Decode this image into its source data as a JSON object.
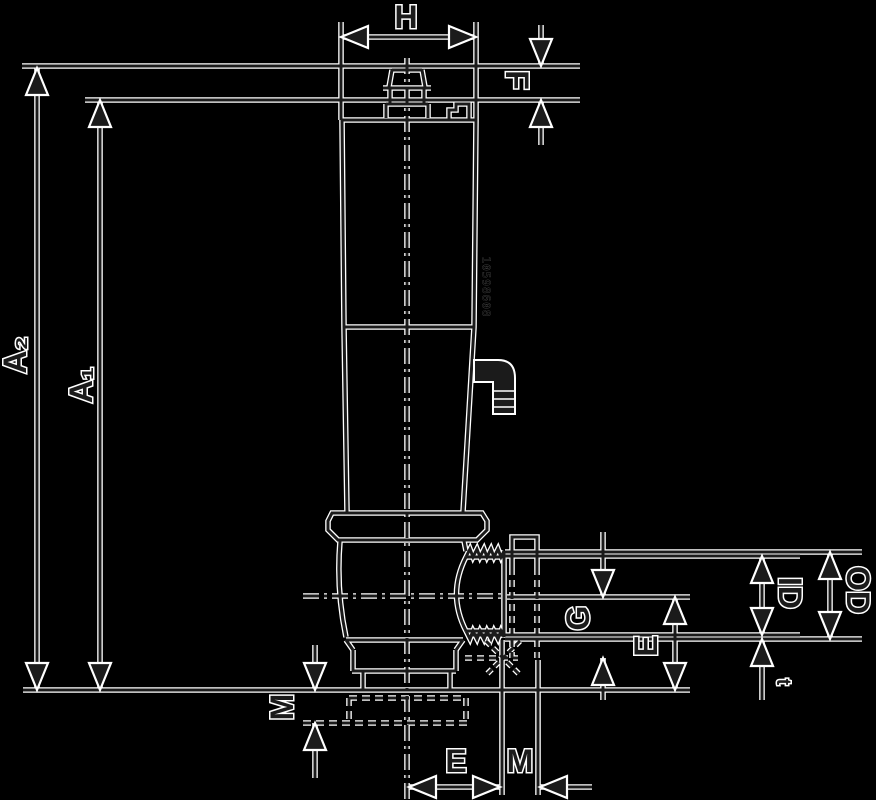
{
  "drawing": {
    "labels": {
      "h": "H",
      "f": "F",
      "a2": "A₂",
      "a1": "A₁",
      "m_left": "M",
      "g": "G",
      "e_right": "E",
      "id": "ID",
      "od": "OD",
      "t": "t",
      "e_bottom": "E",
      "m_bottom": "M"
    },
    "body_marking": "10598608",
    "colors": {
      "background": "#000000",
      "ink": "#1b1b1b",
      "halo": "#ffffff"
    }
  }
}
